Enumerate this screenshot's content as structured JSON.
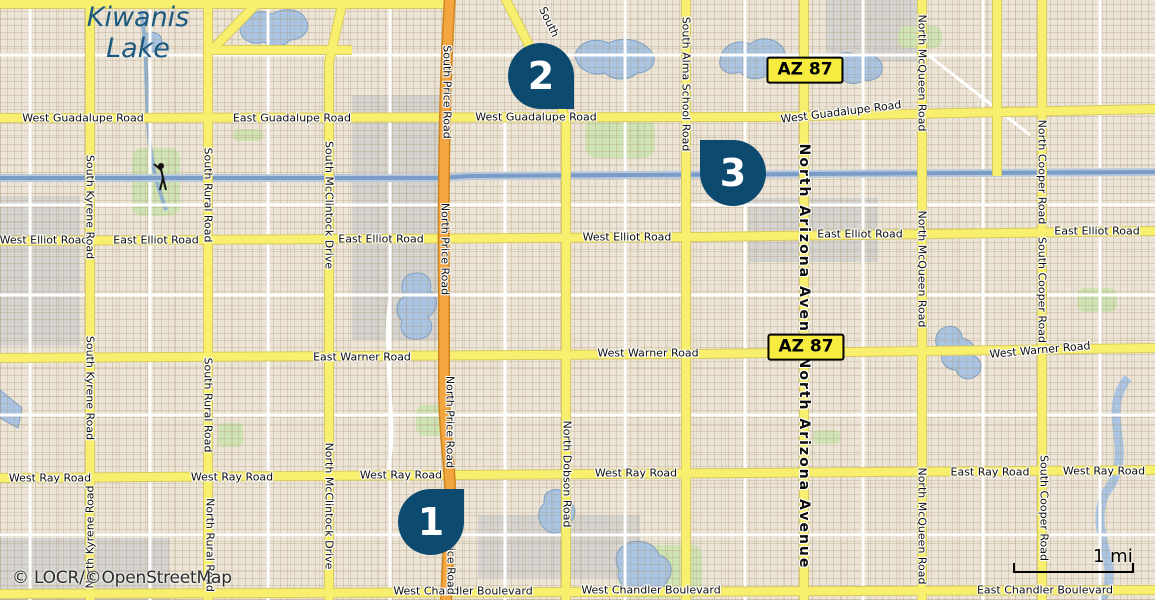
{
  "attribution": "© LOCR/©OpenStreetMap",
  "scale_bar": {
    "label": "1 mi"
  },
  "lake_label": {
    "line1": "Kiwanis",
    "line2": "Lake"
  },
  "route_shields": [
    {
      "label": "AZ 87",
      "x": 805,
      "y": 70
    },
    {
      "label": "AZ 87",
      "x": 806,
      "y": 347
    }
  ],
  "markers": [
    {
      "number": "1",
      "x": 431,
      "y": 522,
      "tip": "top-right"
    },
    {
      "number": "2",
      "x": 541,
      "y": 76,
      "tip": "bottom-right"
    },
    {
      "number": "3",
      "x": 733,
      "y": 173,
      "tip": "top-left"
    }
  ],
  "road_labels": {
    "horizontal": [
      {
        "text": "West Guadalupe Road",
        "x": 83,
        "y": 118
      },
      {
        "text": "East Guadalupe Road",
        "x": 292,
        "y": 118
      },
      {
        "text": "West Guadalupe Road",
        "x": 536,
        "y": 117
      },
      {
        "text": "West Guadalupe Road",
        "x": 841,
        "y": 112,
        "rot": -7
      },
      {
        "text": "West Elliot Road",
        "x": 44,
        "y": 240
      },
      {
        "text": "East Elliot Road",
        "x": 156,
        "y": 240
      },
      {
        "text": "East Elliot Road",
        "x": 381,
        "y": 239
      },
      {
        "text": "West Elliot Road",
        "x": 627,
        "y": 237
      },
      {
        "text": "East Elliot Road",
        "x": 860,
        "y": 234
      },
      {
        "text": "East Elliot Road",
        "x": 1097,
        "y": 231
      },
      {
        "text": "East Warner Road",
        "x": 362,
        "y": 357
      },
      {
        "text": "West Warner Road",
        "x": 648,
        "y": 353
      },
      {
        "text": "West Warner Road",
        "x": 1040,
        "y": 350,
        "rot": -5
      },
      {
        "text": "West Ray Road",
        "x": 50,
        "y": 478
      },
      {
        "text": "West Ray Road",
        "x": 232,
        "y": 477
      },
      {
        "text": "West Ray Road",
        "x": 401,
        "y": 475
      },
      {
        "text": "West Ray Road",
        "x": 636,
        "y": 473
      },
      {
        "text": "East Ray Road",
        "x": 990,
        "y": 472
      },
      {
        "text": "West Ray Road",
        "x": 1104,
        "y": 471
      },
      {
        "text": "West Chandler Boulevard",
        "x": 463,
        "y": 591
      },
      {
        "text": "West Chandler Boulevard",
        "x": 651,
        "y": 590
      },
      {
        "text": "East Chandler Boulevard",
        "x": 1045,
        "y": 590
      },
      {
        "text": "South",
        "x": 549,
        "y": 22,
        "rot": 64
      }
    ],
    "vertical": [
      {
        "text": "South Kyrene Road",
        "x": 90,
        "y": 207
      },
      {
        "text": "South Kyrene Road",
        "x": 90,
        "y": 388
      },
      {
        "text": "North Kyrene Road",
        "x": 90,
        "y": 537,
        "dir": "up"
      },
      {
        "text": "South Rural Road",
        "x": 208,
        "y": 195
      },
      {
        "text": "South Rural Road",
        "x": 208,
        "y": 405
      },
      {
        "text": "North Rural Road",
        "x": 210,
        "y": 545
      },
      {
        "text": "South McClintock Drive",
        "x": 329,
        "y": 205
      },
      {
        "text": "North McClintock Drive",
        "x": 329,
        "y": 506
      },
      {
        "text": "South Price Road",
        "x": 447,
        "y": 92
      },
      {
        "text": "North Price Road",
        "x": 445,
        "y": 249
      },
      {
        "text": "North Price Road",
        "x": 450,
        "y": 422
      },
      {
        "text": "South Price Road",
        "x": 451,
        "y": 548
      },
      {
        "text": "North Dobson Road",
        "x": 567,
        "y": 474
      },
      {
        "text": "South Alma School Road",
        "x": 686,
        "y": 84
      },
      {
        "text": "North Arizona Avenue",
        "x": 804,
        "y": 250,
        "bold": true
      },
      {
        "text": "North Arizona Avenue",
        "x": 804,
        "y": 463,
        "bold": true
      },
      {
        "text": "North McQueen Road",
        "x": 922,
        "y": 73
      },
      {
        "text": "North McQueen Road",
        "x": 922,
        "y": 269
      },
      {
        "text": "North McQueen Road",
        "x": 922,
        "y": 526
      },
      {
        "text": "North Cooper Road",
        "x": 1042,
        "y": 172
      },
      {
        "text": "South Cooper Road",
        "x": 1042,
        "y": 290
      },
      {
        "text": "South Cooper Road",
        "x": 1044,
        "y": 508
      }
    ]
  },
  "colors": {
    "marker": "#0d4a70",
    "shield_bg": "#f6ec3f",
    "road_yellow": "#f8ef6e",
    "road_casing": "#d9cb5c",
    "highway_orange": "#f3a53f",
    "highway_casing": "#cf851d",
    "water": "#a9c5e3",
    "water_edge": "#7e9fc4",
    "canal": "#7b9cc6",
    "green": "#cfe3b4",
    "gray": "#d5d4d0",
    "lake_text": "#1d5a80"
  }
}
